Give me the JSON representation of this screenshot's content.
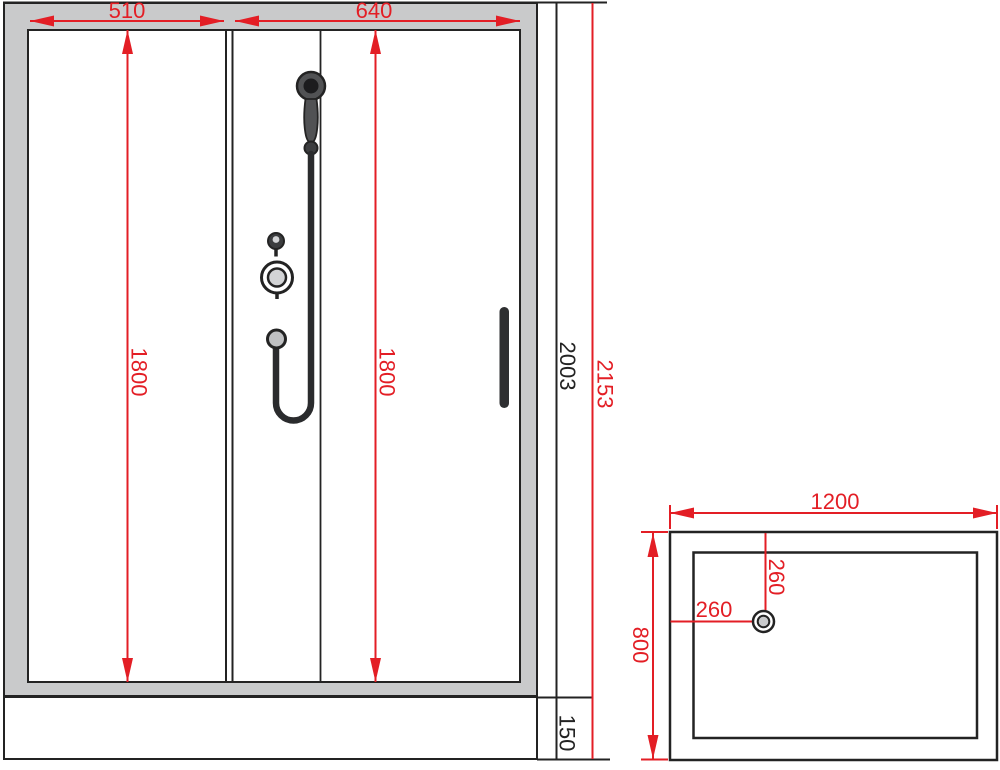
{
  "meta": {
    "title": "Shower cabin technical drawing"
  },
  "front_view": {
    "dim_panel_left_width": "510",
    "dim_panel_right_width": "640",
    "dim_height_left": "1800",
    "dim_height_right": "1800",
    "dim_glass_height": "2003",
    "dim_total_height": "2153",
    "dim_tray_height": "150"
  },
  "top_view": {
    "dim_width": "1200",
    "dim_depth": "800",
    "dim_drain_offset_top": "260",
    "dim_drain_offset_left": "260"
  },
  "colors": {
    "dimension_red": "#e31e25",
    "line_black": "#232323",
    "frame_gray": "#c9cacb",
    "fixture_dark_gray": "#515254",
    "fixture_light_gray": "#d2d3d5"
  }
}
